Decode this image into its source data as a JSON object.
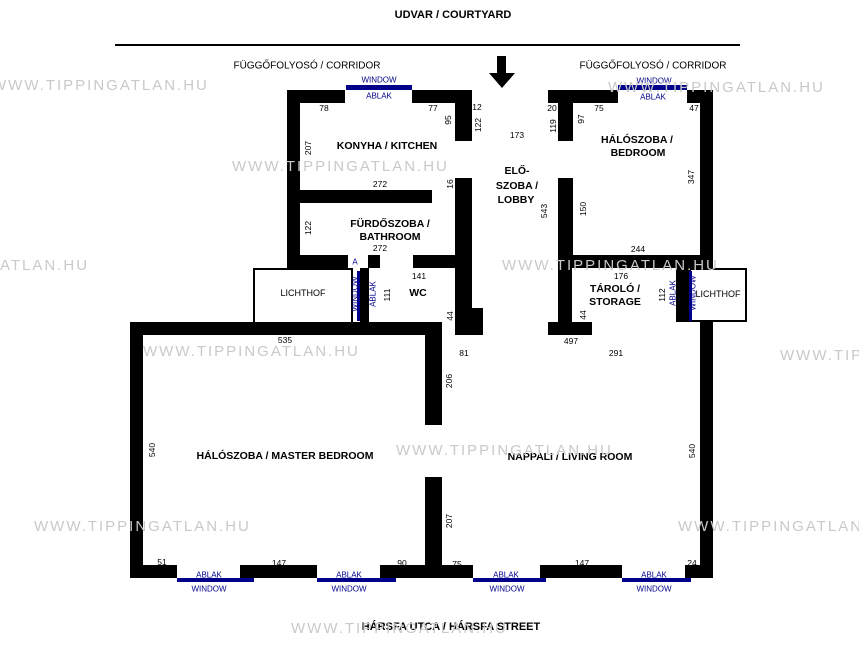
{
  "header": {
    "courtyard": "UDVAR / COURTYARD",
    "corridor": "FÜGGŐFOLYOSÓ / CORRIDOR"
  },
  "footer": {
    "street": "HÁRSFA UTCA / HÁRSFA STREET"
  },
  "watermark": {
    "full": "WWW.TIPPINGATLAN.HU",
    "left_partial": "ATLAN.HU",
    "right_partial": "WWW.TIPP"
  },
  "colors": {
    "wall": "#000000",
    "window_accent": "#00008b",
    "watermark": "#c9c9c9"
  },
  "rooms": {
    "kitchen": "KONYHA / KITCHEN",
    "bathroom1": "FÜRDŐSZOBA /",
    "bathroom2": "BATHROOM",
    "lobby1": "ELŐ-",
    "lobby2": "SZOBA /",
    "lobby3": "LOBBY",
    "bedroom1": "HÁLÓSZOBA /",
    "bedroom2": "BEDROOM",
    "wc": "WC",
    "storage1": "TÁROLÓ /",
    "storage2": "STORAGE",
    "lichthof": "LICHTHOF",
    "master": "HÁLÓSZOBA / MASTER BEDROOM",
    "living": "NAPPALI / LIVING ROOM"
  },
  "win": {
    "ablak": "ABLAK",
    "window": "WINDOW",
    "a": "A"
  },
  "dims": {
    "k78": "78",
    "k77": "77",
    "k12": "12",
    "k95": "95",
    "k122": "122",
    "k207": "207",
    "k272": "272",
    "k16": "16",
    "b122": "122",
    "b272": "272",
    "e173": "173",
    "h20": "20",
    "h119": "119",
    "h97": "97",
    "h75": "75",
    "h47": "47",
    "h347": "347",
    "h150": "150",
    "h244": "244",
    "l543": "543",
    "wc141": "141",
    "wc111": "111",
    "wc44": "44",
    "s176": "176",
    "s112": "112",
    "s44": "44",
    "m535": "535",
    "m540": "540",
    "m51": "51",
    "m147": "147",
    "m90": "90",
    "lv497": "497",
    "lv291": "291",
    "lv81": "81",
    "lv206": "206",
    "lv207": "207",
    "lv540": "540",
    "lv75": "75",
    "lv147": "147",
    "lv24": "24"
  }
}
